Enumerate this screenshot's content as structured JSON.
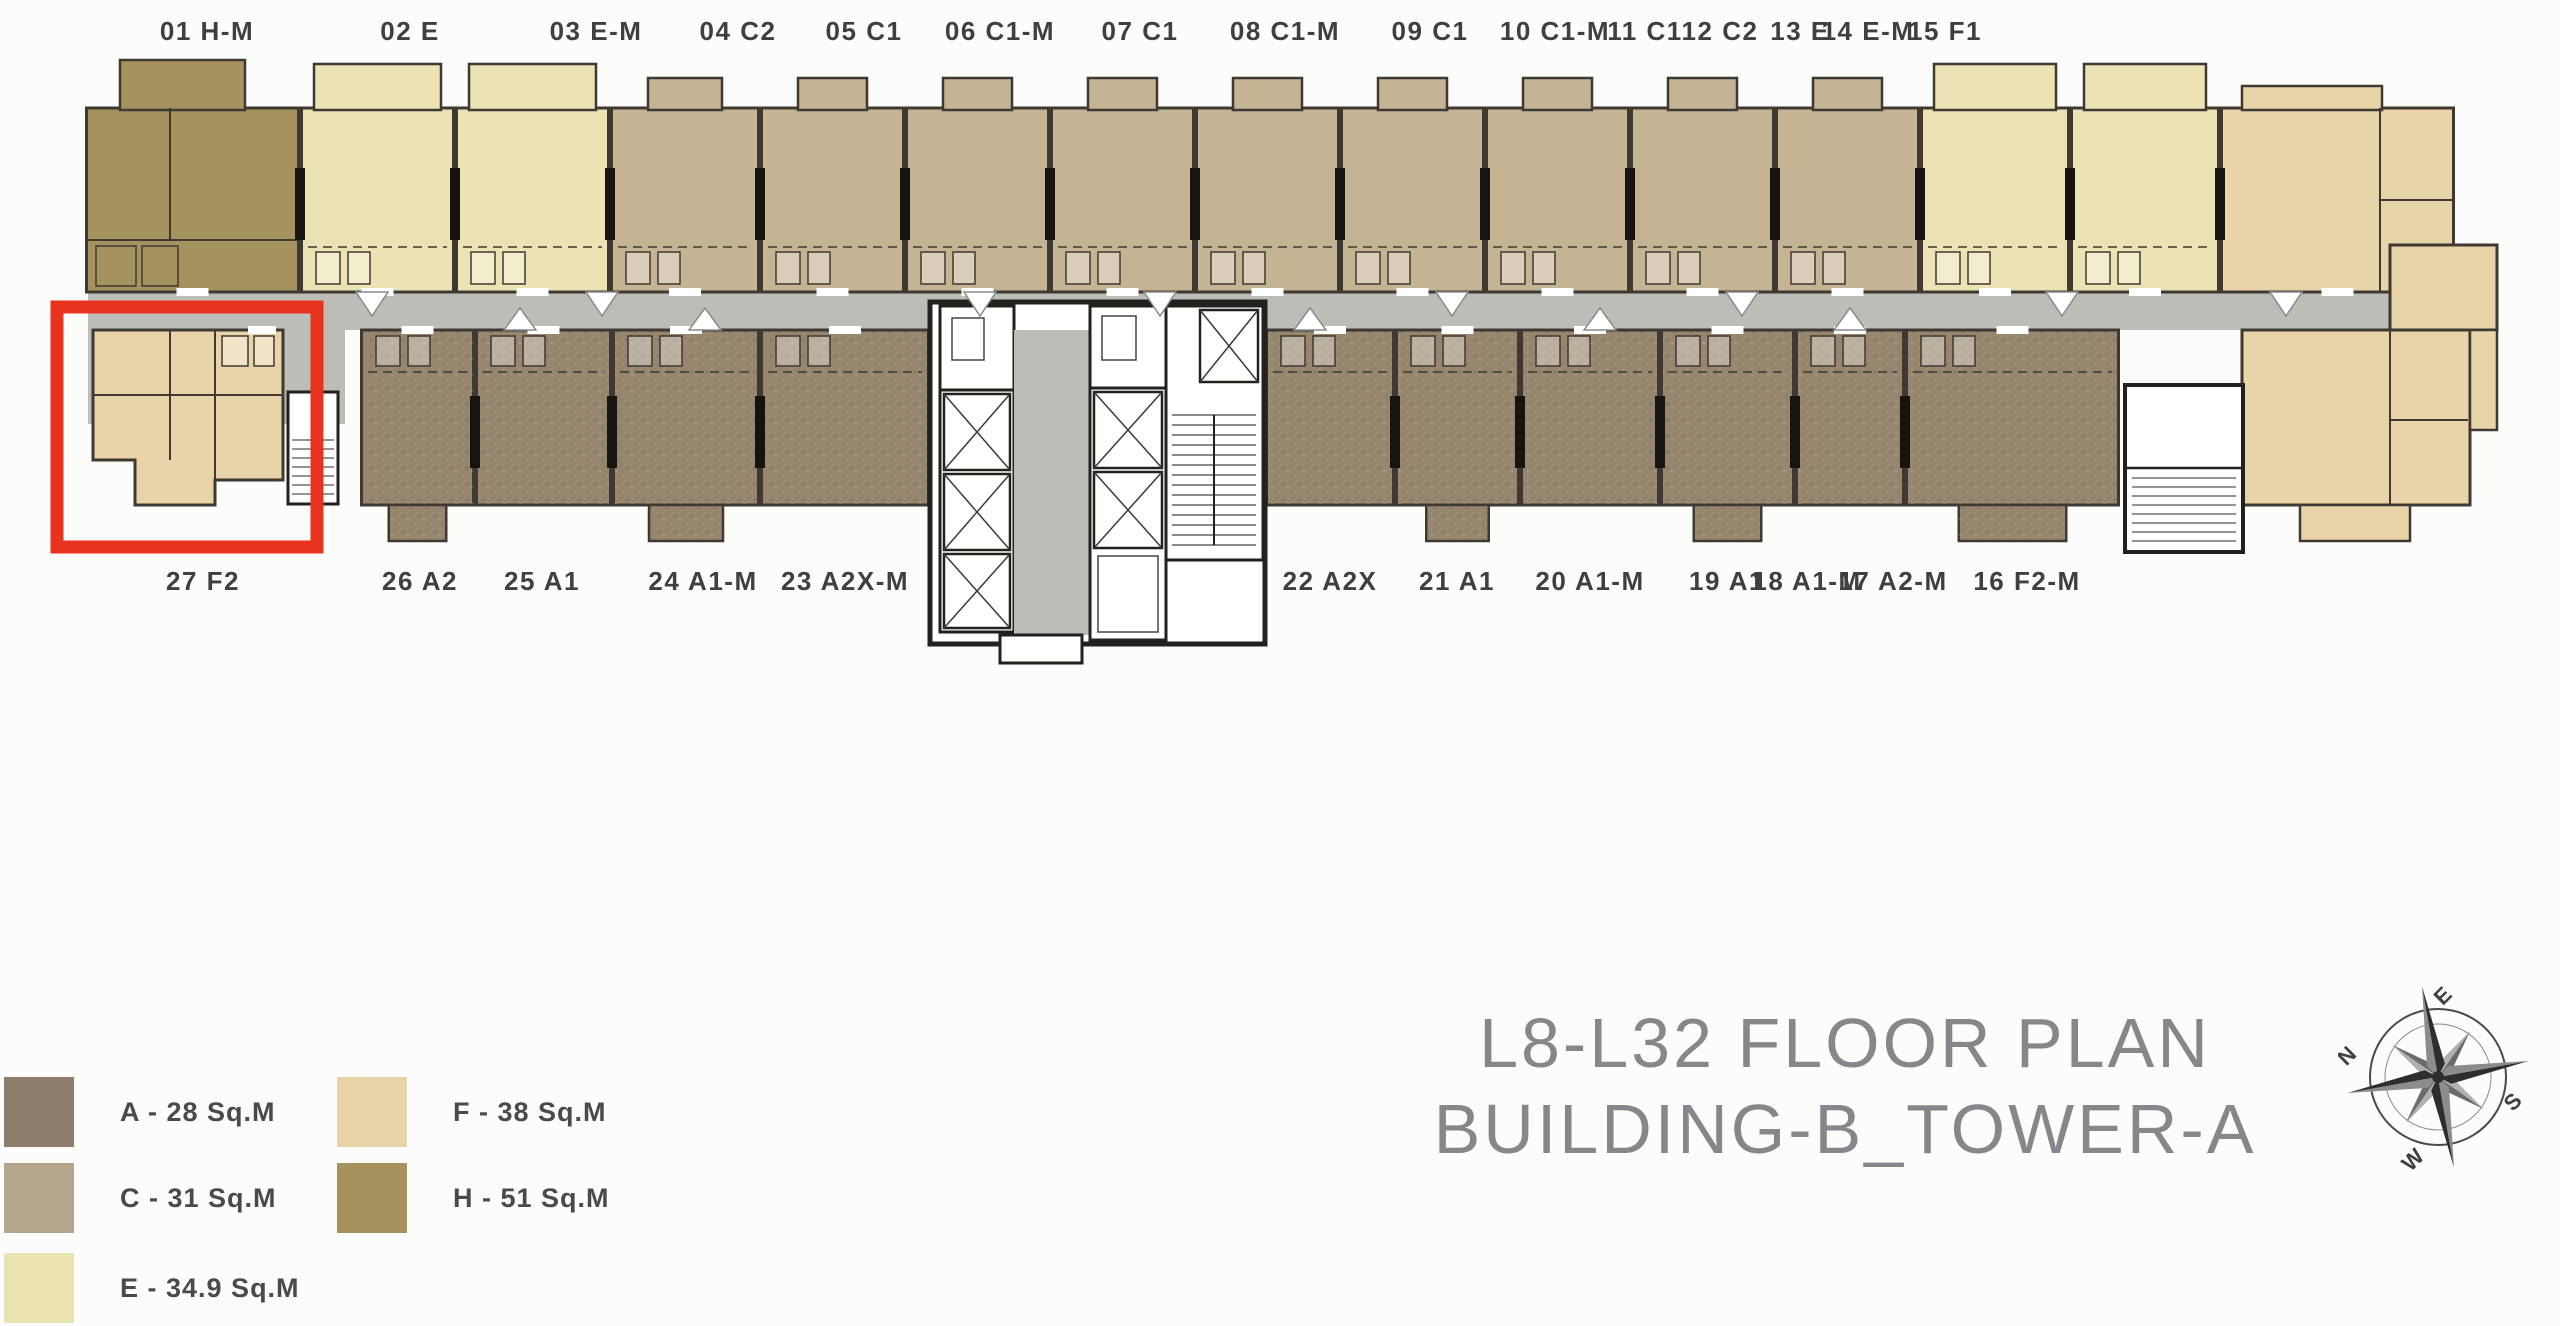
{
  "title": {
    "line1": "L8-L32 FLOOR PLAN",
    "line2": "BUILDING-B_TOWER-A"
  },
  "legend": {
    "items": [
      {
        "code": "A",
        "label": "A - 28 Sq.M",
        "color": "#8d7e6c"
      },
      {
        "code": "C",
        "label": "C - 31 Sq.M",
        "color": "#b4a78e"
      },
      {
        "code": "E",
        "label": "E - 34.9 Sq.M",
        "color": "#eae3b2"
      },
      {
        "code": "F",
        "label": "F - 38 Sq.M",
        "color": "#e9d4aa"
      },
      {
        "code": "H",
        "label": "H - 51 Sq.M",
        "color": "#a6925e"
      }
    ]
  },
  "floor_plan": {
    "top_units": [
      {
        "label": "01 H-M",
        "type": "H"
      },
      {
        "label": "02 E",
        "type": "E"
      },
      {
        "label": "03 E-M",
        "type": "E"
      },
      {
        "label": "04 C2",
        "type": "C"
      },
      {
        "label": "05 C1",
        "type": "C"
      },
      {
        "label": "06 C1-M",
        "type": "C"
      },
      {
        "label": "07 C1",
        "type": "C"
      },
      {
        "label": "08 C1-M",
        "type": "C"
      },
      {
        "label": "09 C1",
        "type": "C"
      },
      {
        "label": "10 C1-M",
        "type": "C"
      },
      {
        "label": "11 C1",
        "type": "C"
      },
      {
        "label": "12 C2",
        "type": "C"
      },
      {
        "label": "13 E",
        "type": "E"
      },
      {
        "label": "14 E-M",
        "type": "E"
      },
      {
        "label": "15 F1",
        "type": "F"
      }
    ],
    "bottom_units": [
      {
        "label": "27 F2",
        "type": "F"
      },
      {
        "label": "26 A2",
        "type": "A"
      },
      {
        "label": "25 A1",
        "type": "A"
      },
      {
        "label": "24 A1-M",
        "type": "A"
      },
      {
        "label": "23 A2X-M",
        "type": "A"
      },
      {
        "label": "22 A2X",
        "type": "A"
      },
      {
        "label": "21 A1",
        "type": "A"
      },
      {
        "label": "20 A1-M",
        "type": "A"
      },
      {
        "label": "19 A1",
        "type": "A"
      },
      {
        "label": "18 A1-M",
        "type": "A"
      },
      {
        "label": "17 A2-M",
        "type": "A"
      },
      {
        "label": "16 F2-M",
        "type": "F"
      }
    ],
    "highlighted_unit": "27 F2",
    "highlight_color": "#e8341f",
    "corridor_color": "#bdbdb7",
    "wall_color": "#3e3933",
    "label_color": "#3f3f3f",
    "plan_colors": {
      "A": "#97876f",
      "C": "#c4b494",
      "E": "#ebe3b3",
      "F": "#e9d4aa",
      "H": "#a6925e"
    }
  },
  "compass": {
    "n": "N",
    "e": "E",
    "s": "S",
    "w": "W"
  }
}
